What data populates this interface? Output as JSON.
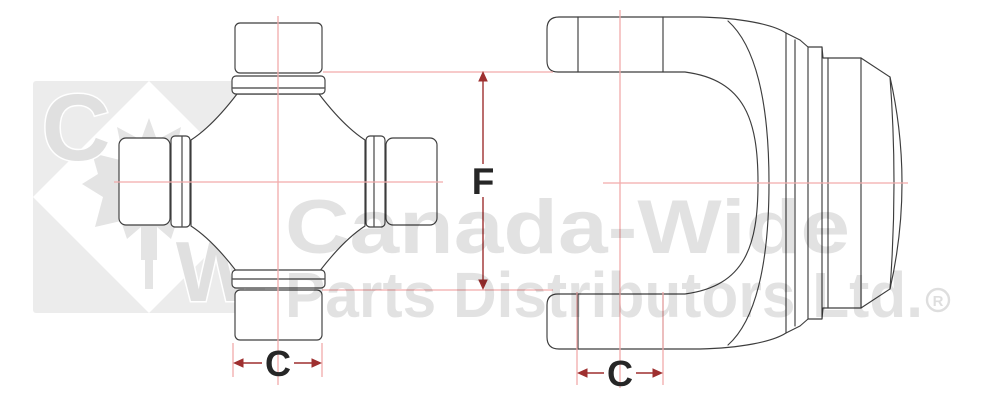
{
  "diagram": {
    "title": "u-joint cross and yoke dimension diagram",
    "dimension_labels": {
      "f": "F",
      "c_cross": "C",
      "c_yoke": "C"
    },
    "watermark": {
      "line1": "Canada-Wide",
      "line2": "Parts Distributors Ltd.",
      "registered": "R",
      "logo_letter_c": "C",
      "logo_letter_w": "W"
    },
    "colors": {
      "outline": "#3d3d3d",
      "centerline_pink": "#f2abab",
      "dimension_red": "#9e2f2f",
      "label_text": "#262626",
      "watermark_gray": "#e3e3e3",
      "logo_background": "#ececec"
    }
  }
}
